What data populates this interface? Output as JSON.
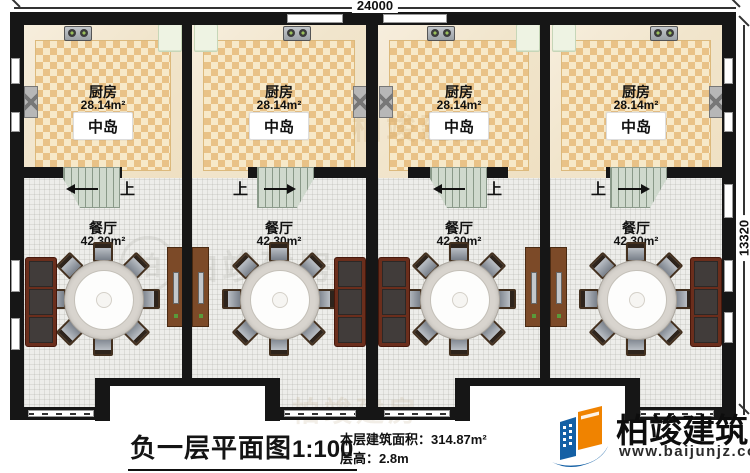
{
  "dimensions": {
    "top": "24000",
    "right": "13320"
  },
  "units": [
    {
      "kitchen": "厨房",
      "kitchen_area": "28.14m²",
      "island": "中岛",
      "up": "上",
      "dining": "餐厅",
      "dining_area": "42.30m²"
    },
    {
      "kitchen": "厨房",
      "kitchen_area": "28.14m²",
      "island": "中岛",
      "up": "上",
      "dining": "餐厅",
      "dining_area": "42.30m²"
    },
    {
      "kitchen": "厨房",
      "kitchen_area": "28.14m²",
      "island": "中岛",
      "up": "上",
      "dining": "餐厅",
      "dining_area": "42.30m²"
    },
    {
      "kitchen": "厨房",
      "kitchen_area": "28.14m²",
      "island": "中岛",
      "up": "上",
      "dining": "餐厅",
      "dining_area": "42.30m²"
    }
  ],
  "title": {
    "text": "负一层平面图",
    "scale": "1:100"
  },
  "info": {
    "area_label": "本层建筑面积：",
    "area_value": "314.87m²",
    "height_label": "层高：",
    "height_value": "2.8m"
  },
  "logo": {
    "name": "柏竣建筑",
    "url": "www.baijunjz.com"
  },
  "watermark": {
    "text": "柏竣建房",
    "initial": "柏"
  },
  "colors": {
    "logo_blue": "#1460a5",
    "logo_orange": "#f08300",
    "tile_orange": "#e9c287",
    "wall": "#161616"
  }
}
